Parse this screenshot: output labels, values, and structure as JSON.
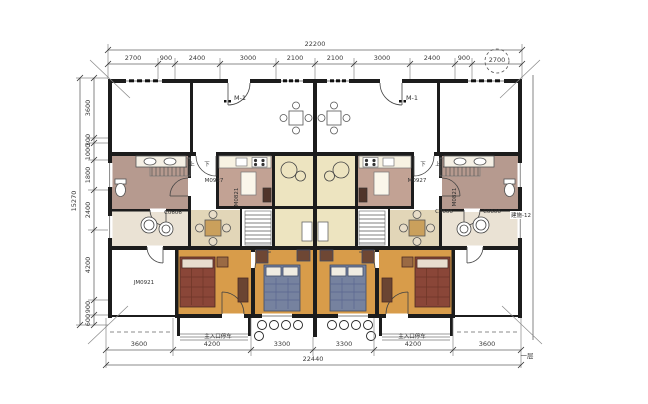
{
  "plan": {
    "floor_note": "一层",
    "sheet_note": "建施-12",
    "entrance_label": "主入口停车",
    "stair_up": "上",
    "stair_down": "下",
    "door_labels": {
      "m1": "M-1",
      "m0927": "M0927",
      "m0821": "M0821",
      "jm0921": "JM0921",
      "c0606": "C0606"
    }
  },
  "dimensions": {
    "top": {
      "total": "22200",
      "segments": [
        "2700",
        "900",
        "2400",
        "3000",
        "2100",
        "2100",
        "3000",
        "2400",
        "900",
        "2700"
      ],
      "circled_segment": "2700"
    },
    "bottom": {
      "total": "22440",
      "segments": [
        "3600",
        "4200",
        "3300",
        "3300",
        "4200",
        "3600"
      ]
    },
    "left": {
      "total": "15270",
      "segments": [
        "3600",
        "300",
        "1000",
        "1800",
        "2400",
        "4200",
        "900",
        "600"
      ]
    }
  },
  "colors": {
    "wall": "#1c1c1c",
    "wood_floor": "#d89c4a",
    "bath_floor": "#b69a8f",
    "kitchen_floor": "#c2a294",
    "dining_floor": "#e2d6b8",
    "breakfast_floor": "#ede4c0",
    "utility_floor": "#eae2d4",
    "bed_red": "#8a4638",
    "bed_blue": "#76829f",
    "furniture_wood": "#6e4734",
    "dim_line": "#666666"
  }
}
